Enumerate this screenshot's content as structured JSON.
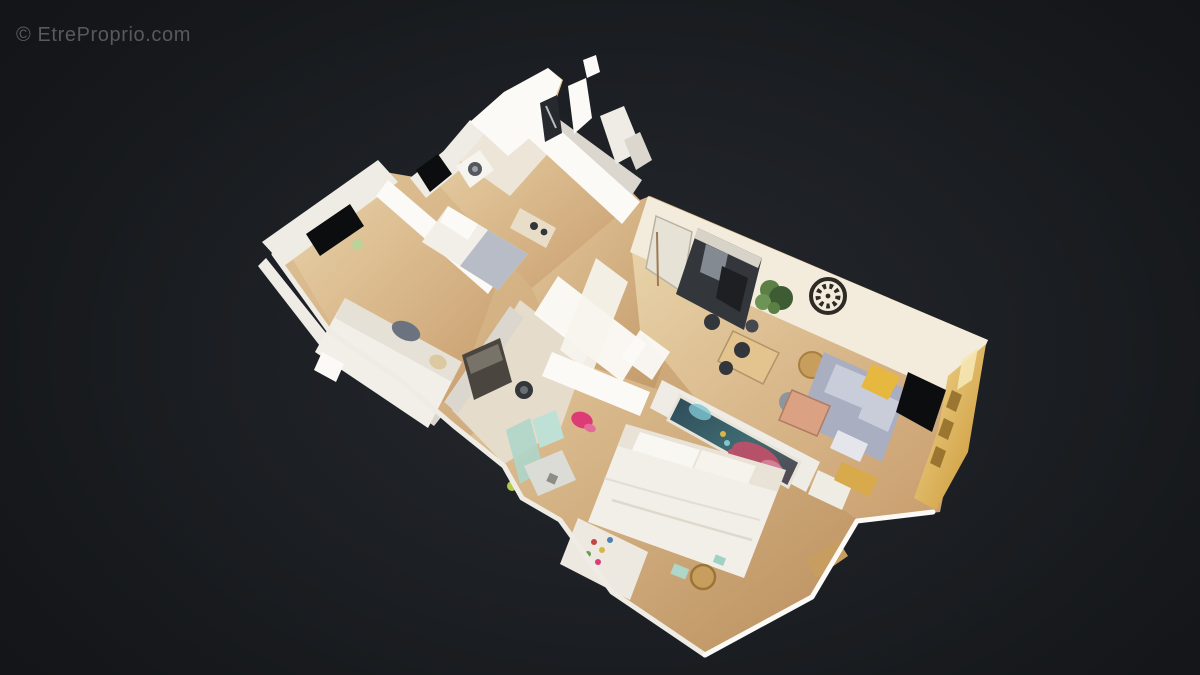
{
  "watermark": {
    "text": "© EtreProprio.com"
  },
  "scene": {
    "type": "3d-dollhouse-cutaway-floorplan",
    "rooms": [
      "bedroom-1",
      "bedroom-2",
      "bathroom",
      "hallway",
      "kitchen-living-room",
      "office-nook",
      "shower-room",
      "master-bedroom"
    ]
  },
  "colors": {
    "bg_center": "#25282d",
    "bg_mid": "#1b1e22",
    "bg_edge": "#131518",
    "watermark": "#565a5f",
    "wall": "#efece5",
    "wall_bright": "#fbfaf7",
    "wall_shade": "#dcd7ce",
    "wall_warm": "#f3ecdc",
    "floor_light": "#e4cb9f",
    "floor_mid": "#d2ad7c",
    "floor_dark": "#bd9261",
    "window": "#0c0d0f",
    "glass_dark": "#26292d",
    "bed": "#f2efe8",
    "bed_shadow": "#ddd5c6",
    "pillow": "#6b7280",
    "blanket": "#b7bcc7",
    "sofa": "#a9aec0",
    "sofa_light": "#c9cdda",
    "throw_yellow": "#e7b83f",
    "copper": "#dba183",
    "pouf_rattan": "#c79e5e",
    "pouf_gray": "#8f959e",
    "plant": "#5c7f45",
    "plant_dark": "#3e5c33",
    "clock": "#2e2a26",
    "gold": "#d9aa4c",
    "gold_light": "#f2da96",
    "art_base": "#34525f",
    "art_teal": "#3f6b72",
    "art_red": "#c25068",
    "art_pink": "#d887a0",
    "art_blue": "#7fc6d2",
    "art_yellow": "#d8b544",
    "pink_item": "#dd3b76",
    "mint": "#aed6c9",
    "lime": "#b5c94f",
    "dark_item": "#33363b",
    "steel": "#98a0a7",
    "wood_tan": "#c79d60"
  }
}
